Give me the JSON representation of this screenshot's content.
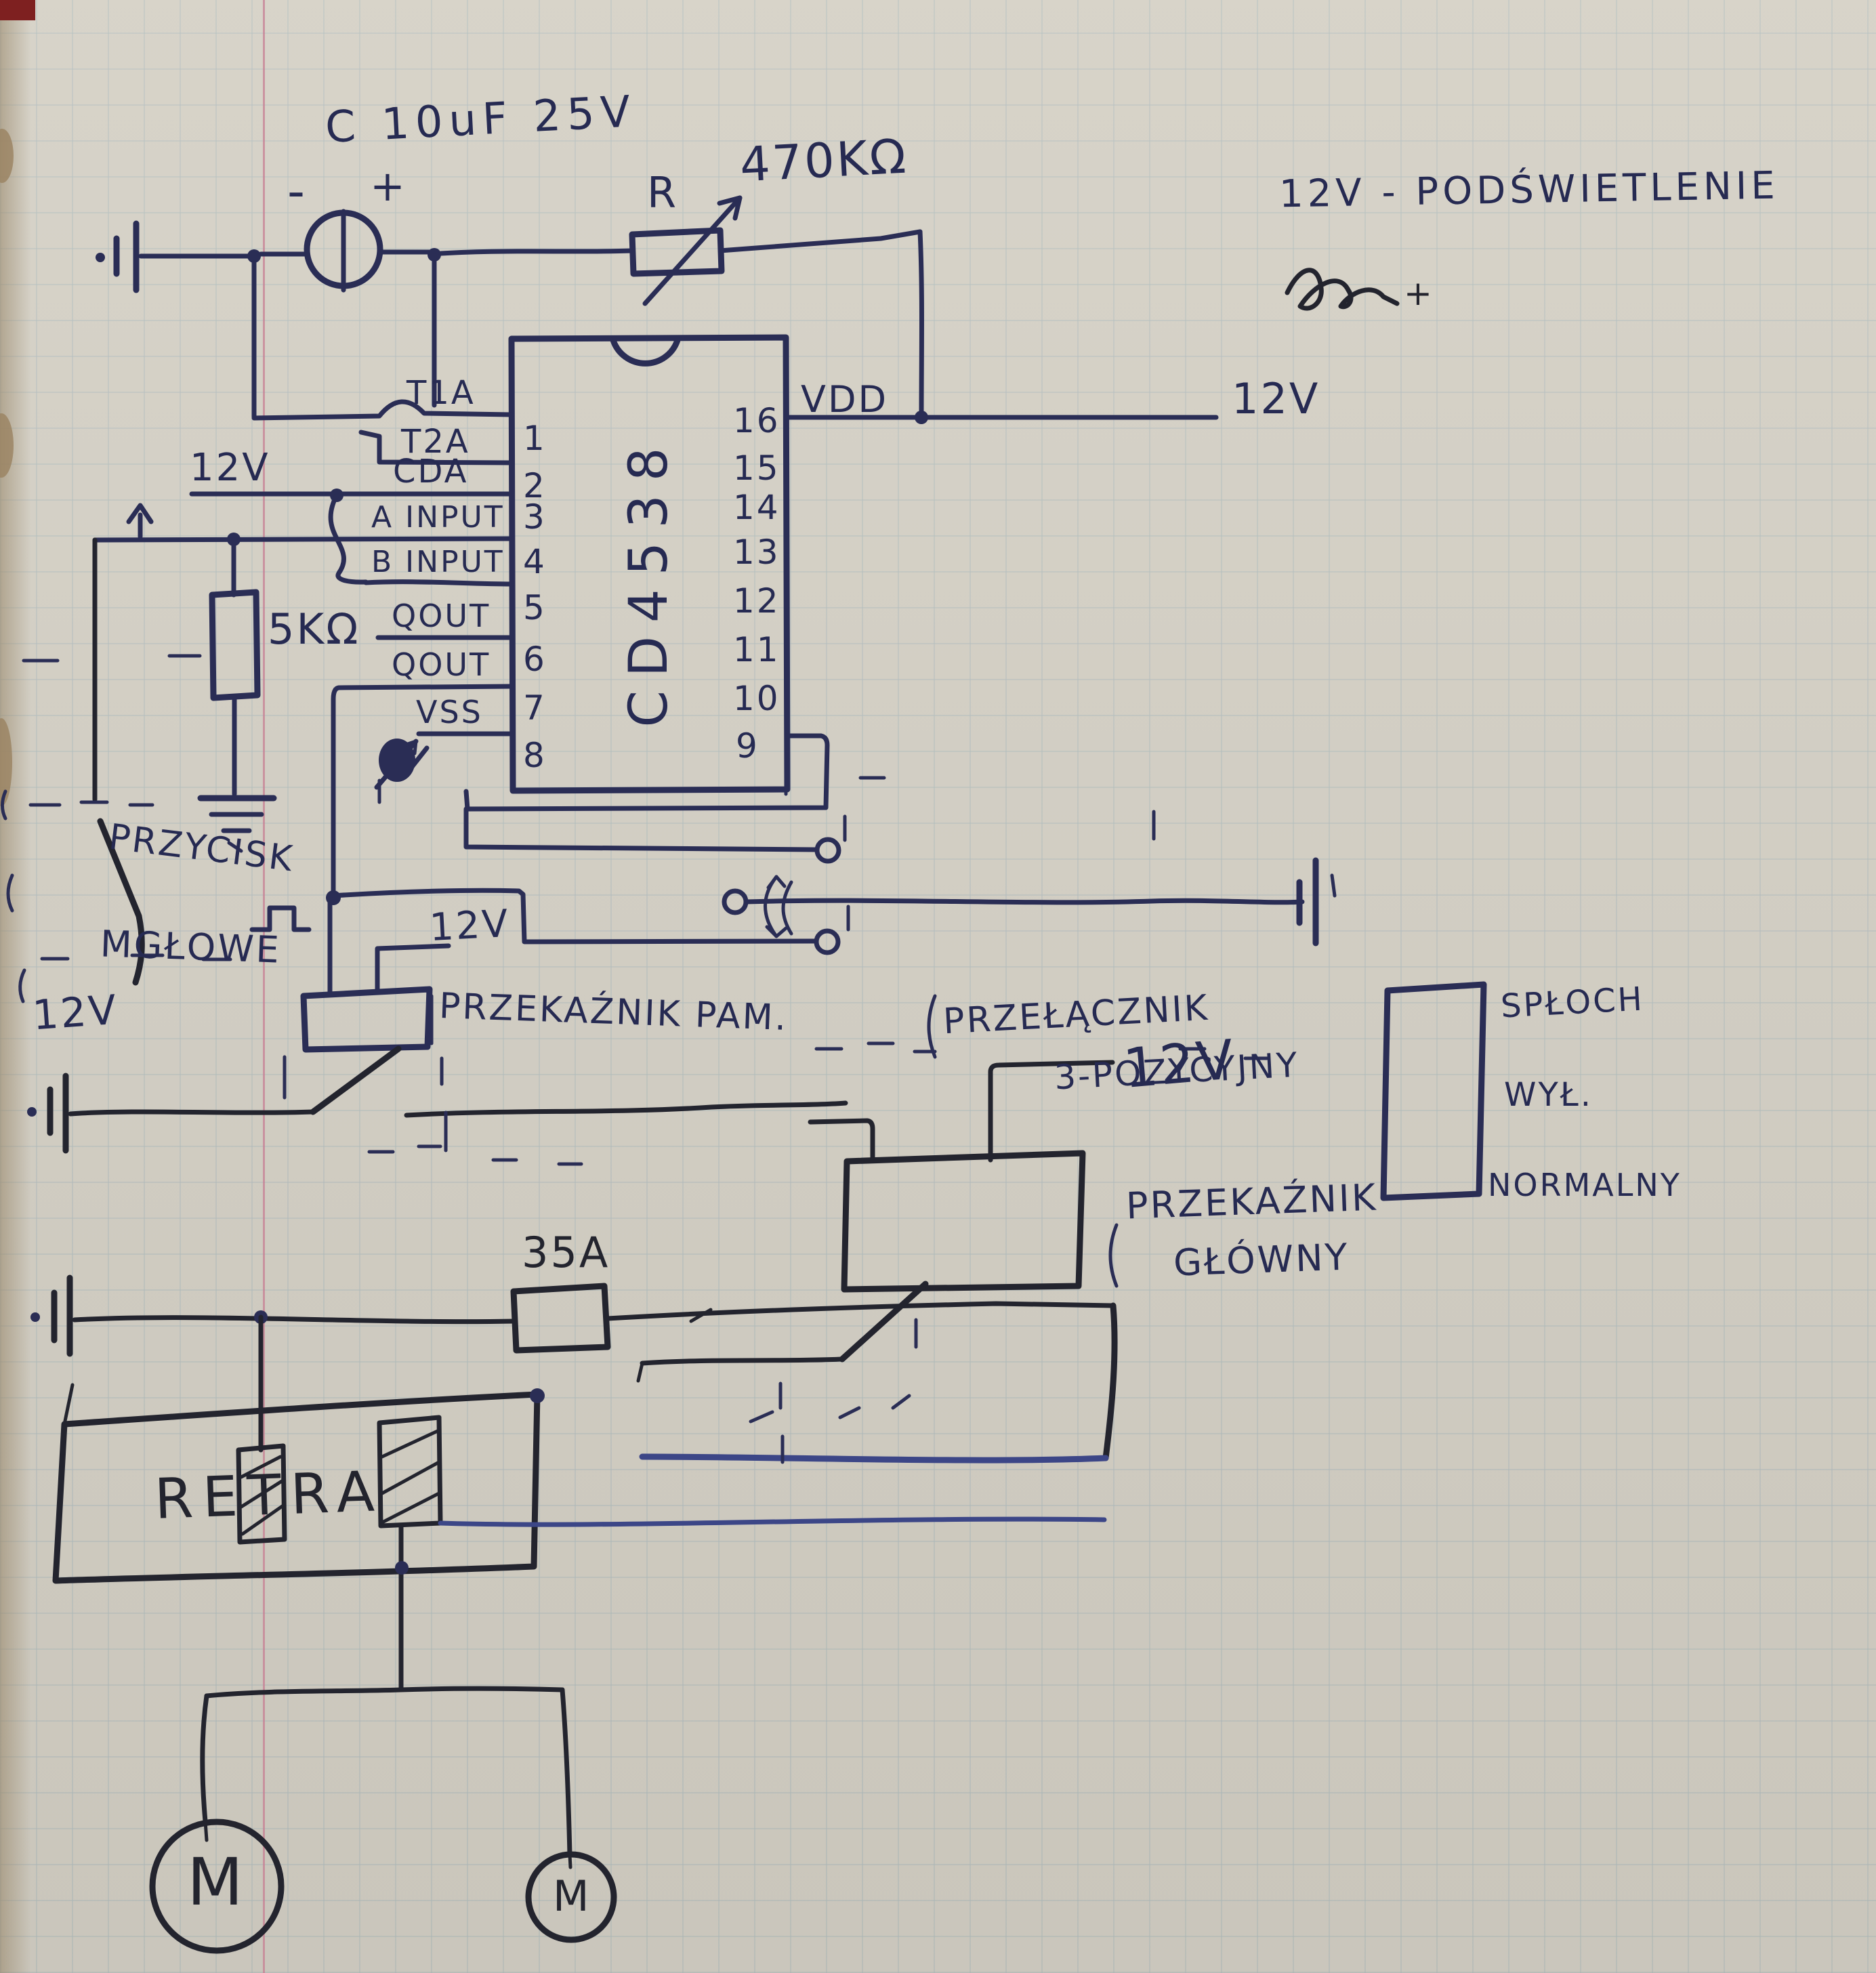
{
  "colors": {
    "ink": "#2a2d55",
    "ink_black": "#23242e",
    "paper": "#cfcbc0",
    "grid": "#92aab4",
    "margin_line": "#c77f93"
  },
  "labels": {
    "capacitor": "C 10uF 25V",
    "cap_minus": "-",
    "cap_plus": "+",
    "pot_ref": "R",
    "pot_value": "470KΩ",
    "note_backlight": "12V - PODŚWIETLENIE",
    "note_plus": "+",
    "vdd": "VDD",
    "v12_vdd": "12V",
    "v12_cda": "12V",
    "res_5k": "5KΩ",
    "przycisk_1": "PRZYCISK",
    "przycisk_2": "MGŁOWE",
    "v12_left": "12V",
    "v12_pam": "12V",
    "pam": "PRZEKAŹNIK PAM.",
    "sw3_1": "PRZEŁĄCZNIK",
    "sw3_2": "3-POZYCYJNY",
    "sploch_1": "SPŁOCH",
    "sploch_2": "WYŁ.",
    "sploch_3": "NORMALNY",
    "glowny_1": "PRZEKAŹNIK",
    "glowny_2": "GŁÓWNY",
    "v12_glowny": "12V",
    "fuse": "35A",
    "retra": "RETRA",
    "motor_1": "M",
    "motor_2": "M"
  },
  "ic": {
    "name": "CD4538",
    "left_pins": [
      {
        "name": "T1A",
        "num": "1"
      },
      {
        "name": "T2A",
        "num": "2"
      },
      {
        "name": "CDA",
        "num": "3"
      },
      {
        "name": "A INPUT",
        "num": "4"
      },
      {
        "name": "B INPUT",
        "num": "5"
      },
      {
        "name": "QOUT",
        "num": "6"
      },
      {
        "name": "QOUT",
        "num": "7"
      },
      {
        "name": "VSS",
        "num": "8"
      }
    ],
    "right_pins": [
      "16",
      "15",
      "14",
      "13",
      "12",
      "11",
      "10",
      "9"
    ]
  }
}
